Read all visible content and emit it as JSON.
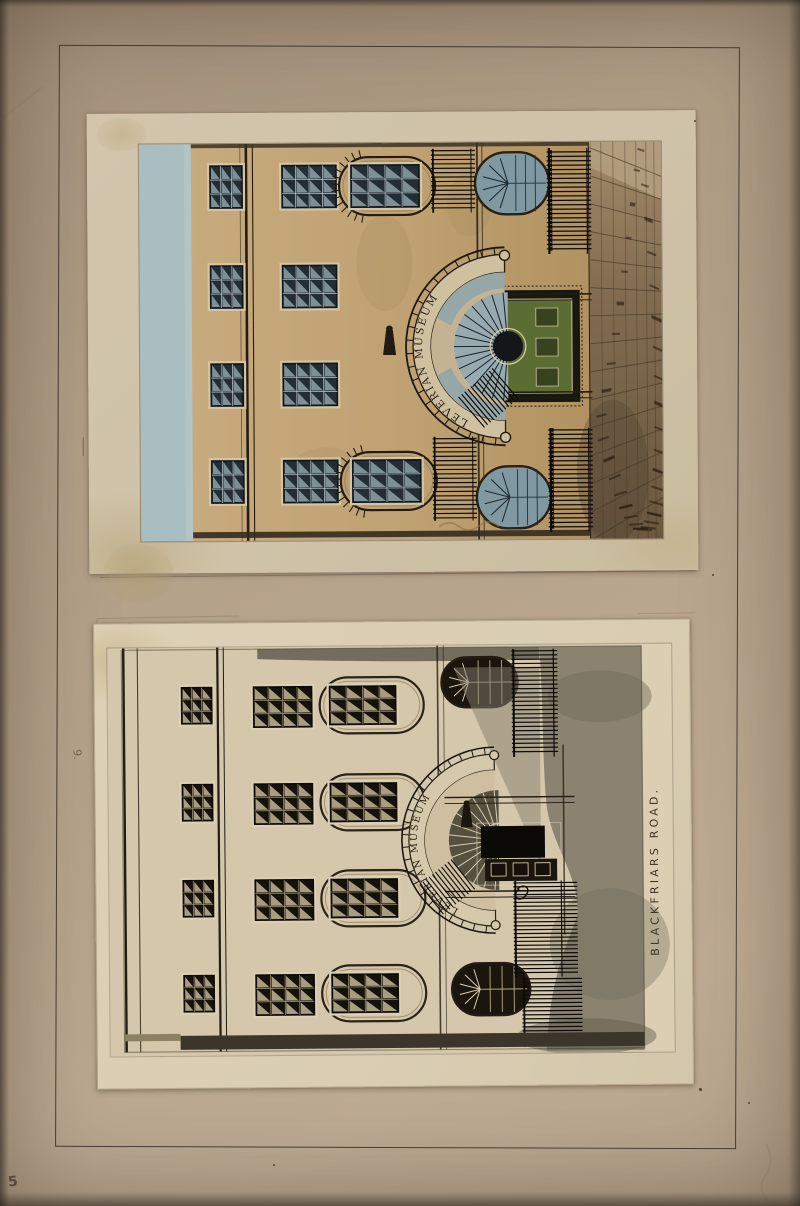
{
  "artwork": {
    "title": "Leverian Museum — two mounted elevation drawings",
    "frieze_inscription": "LEVERIAN MUSEUM",
    "street_inscription": "BLACKFRIARS ROAD.",
    "annotations": {
      "top_plate_number": "10",
      "bottom_plate_number": "9.",
      "corner_number": "5"
    },
    "palette": {
      "mount": "#b2a089",
      "top_sheet": "#cfc2a8",
      "bottom_sheet": "#dacdb3",
      "facade_tan": "#c0a273",
      "sky_wash": "#a9bec0",
      "ink": "#241c12",
      "street_wash": "#8b8370",
      "door_green": "#5c6d34",
      "glazing_blue": "#8ea6ae"
    }
  }
}
